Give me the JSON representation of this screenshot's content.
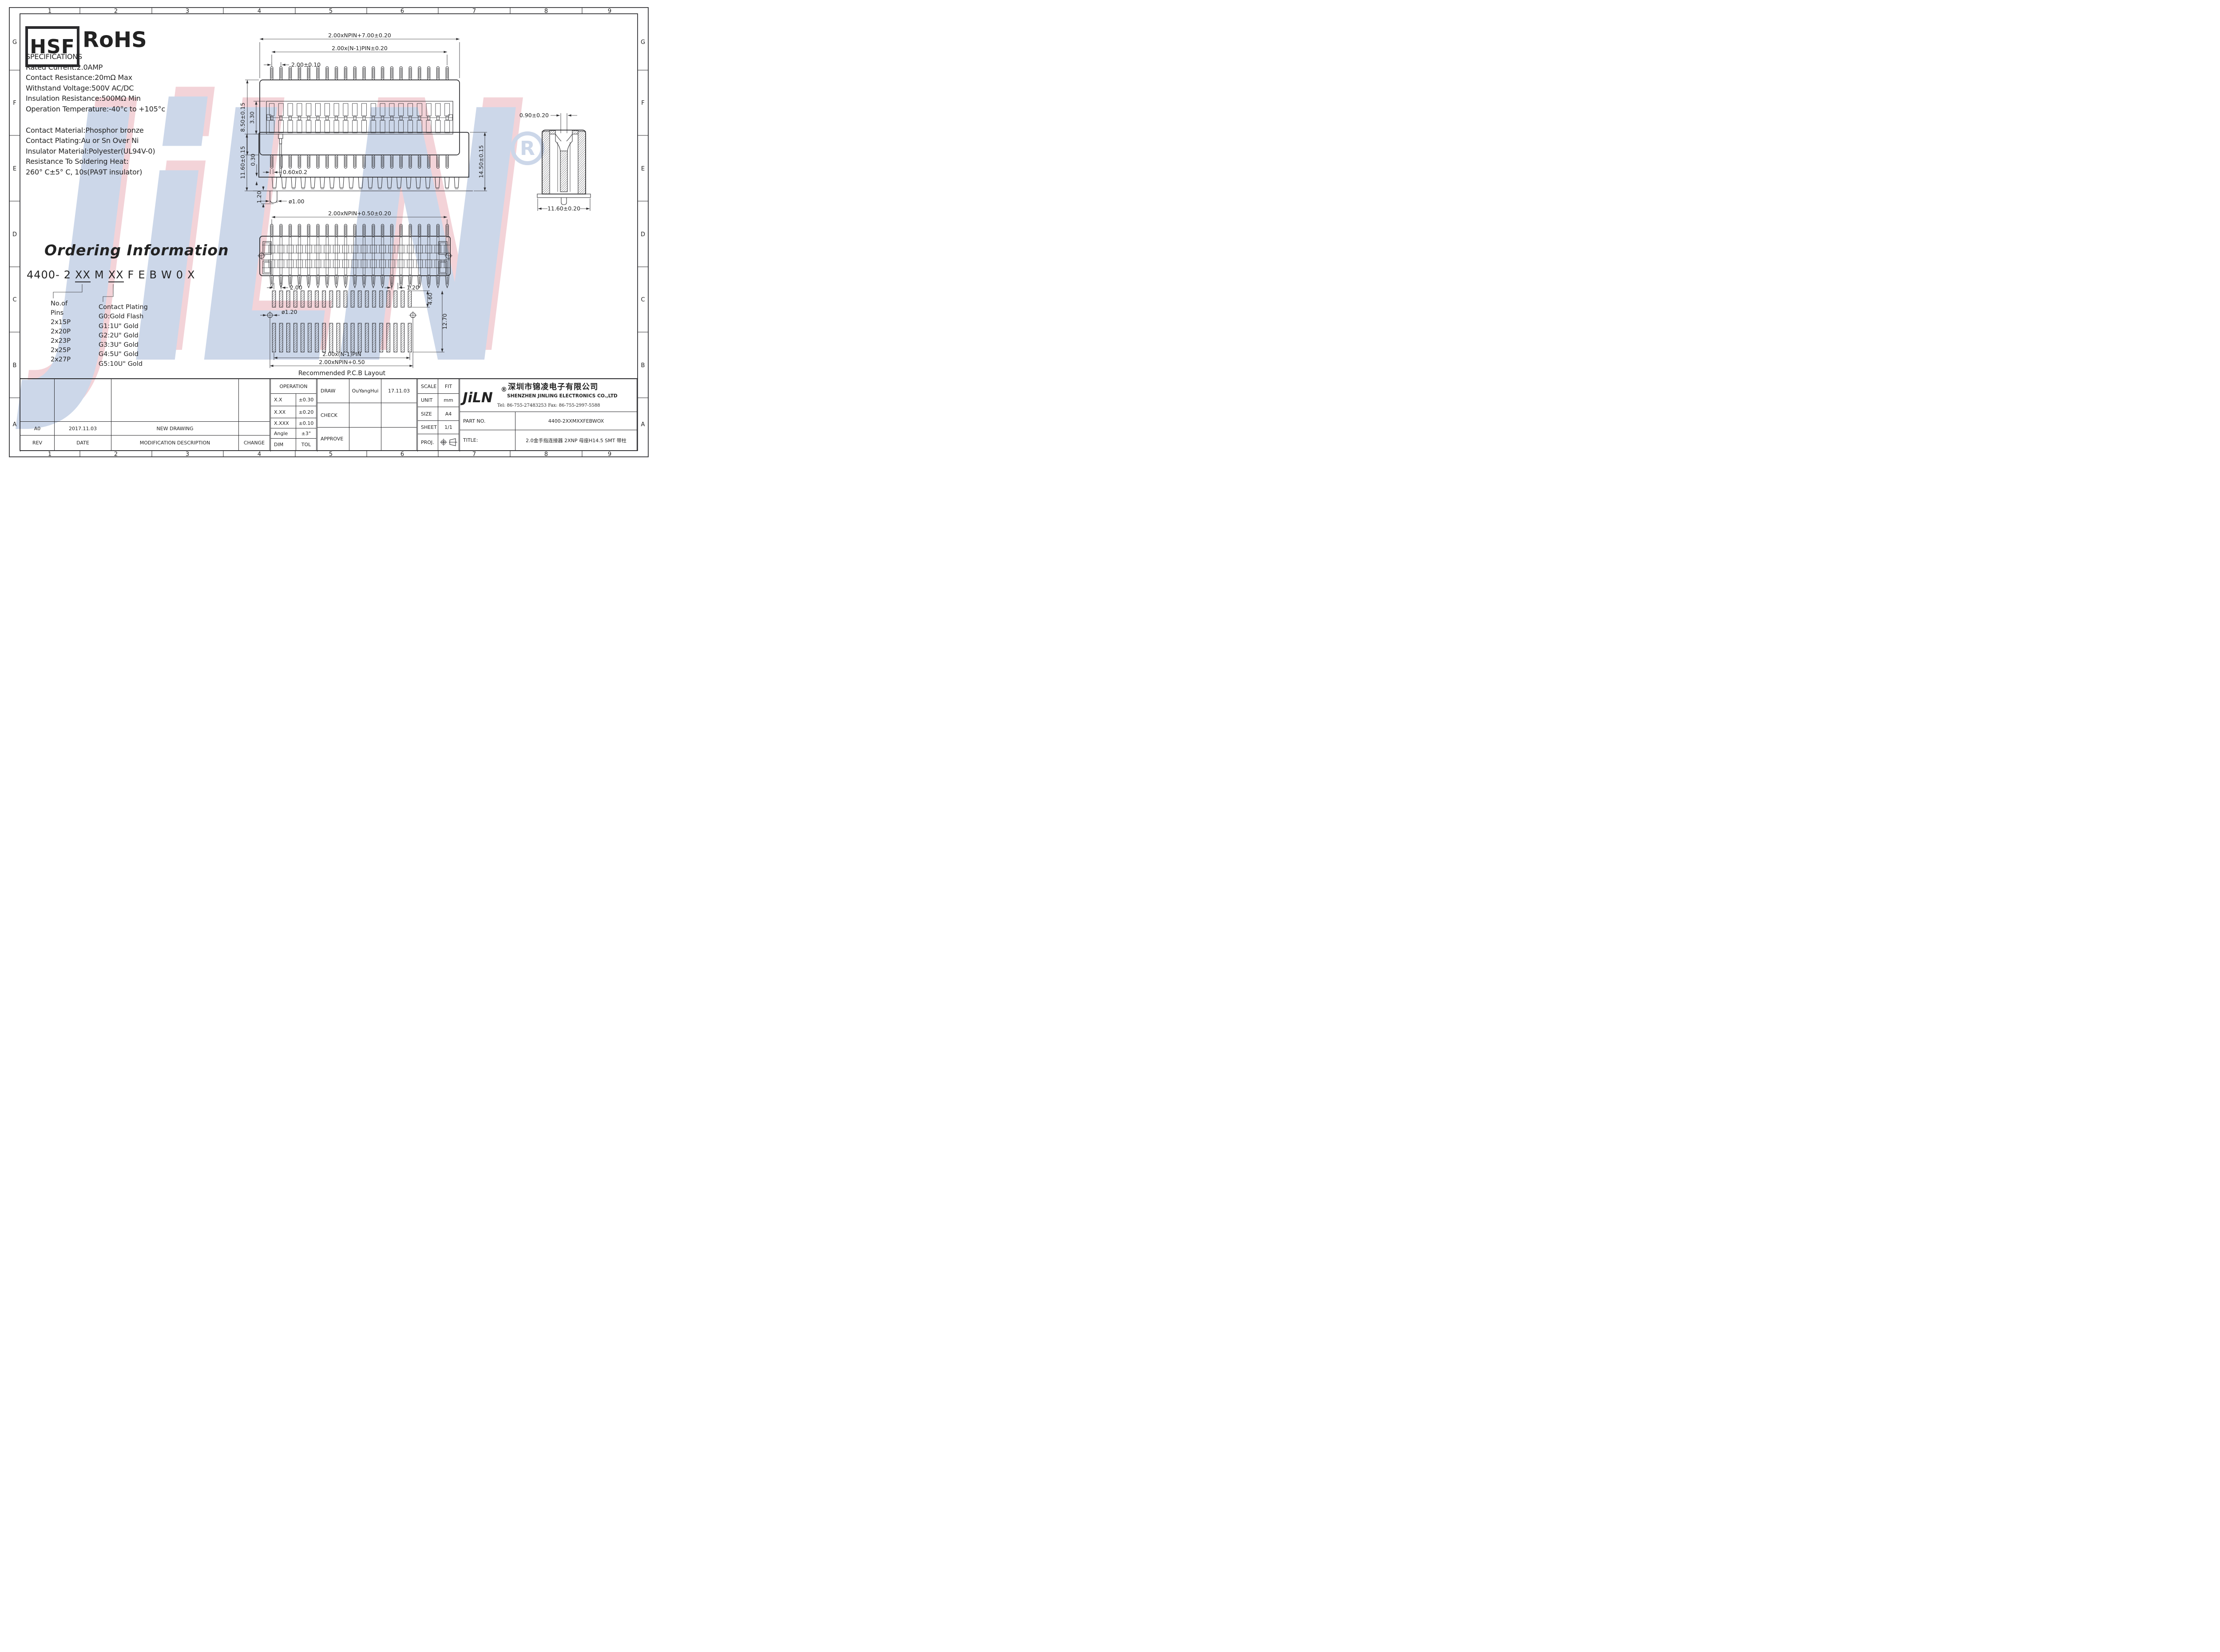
{
  "sheet": {
    "bg": "#ffffff",
    "line": "#2b2b2e"
  },
  "grid": {
    "cols": [
      "1",
      "2",
      "3",
      "4",
      "5",
      "6",
      "7",
      "8",
      "9"
    ],
    "rows": [
      "G",
      "F",
      "E",
      "D",
      "C",
      "B",
      "A"
    ]
  },
  "badges": {
    "hsf": "HSF",
    "rohs": "RoHS"
  },
  "specifications": {
    "title": "SPECIFICATIONS",
    "lines": [
      "Rated Current:2.0AMP",
      "Contact Resistance:20mΩ Max",
      "Withstand Voltage:500V AC/DC",
      "Insulation Resistance:500MΩ Min",
      "Operation Temperature:-40°c to +105°c"
    ],
    "lines2": [
      "Contact Material:Phosphor bronze",
      "Contact Plating:Au or Sn Over Ni",
      "Insulator Material:Polyester(UL94V-0)",
      "Resistance To Soldering Heat:",
      "260° C±5° C, 10s(PA9T insulator)"
    ]
  },
  "ordering": {
    "title": "Ordering Information",
    "code": {
      "c1": "4400-",
      "c2": "2",
      "c3": "XX",
      "c4": "M",
      "c5": "XX",
      "c6": "F",
      "c7": "E",
      "c8": "B",
      "c9": "W",
      "c10": "0",
      "c11": "X"
    },
    "pins": [
      "No.of",
      "Pins",
      "2x15P",
      "2x20P",
      "2x23P",
      "2x25P",
      "2x27P"
    ],
    "plating": [
      "Contact Plating",
      "G0:Gold Flash",
      "G1:1U\" Gold",
      "G2:2U\" Gold",
      "G3:3U\" Gold",
      "G4:5U\" Gold",
      "G5:10U\" Gold"
    ]
  },
  "dims": {
    "top": {
      "d1": "2.00xNPIN+7.00±0.20",
      "d2": "2.00x(N-1)PIN±0.20",
      "d3": "2.00±0.10",
      "d4": "8.50±0.15",
      "d5": "3.30",
      "d6": "0.60x0.2"
    },
    "side": {
      "d1": "11.60±0.15",
      "d2": "0.30",
      "d3": "1.20",
      "d4": "ø1.00",
      "d5": "14.50±0.15"
    },
    "front": {
      "d1": "2.00xNPIN+0.50±0.20"
    },
    "detail": {
      "d1": "0.90±0.20",
      "d2": "11.60±0.20"
    },
    "pcb": {
      "d1": "2.00",
      "d2": "1.20",
      "d3": "4.60",
      "d4": "12.70",
      "d5": "ø1.20",
      "d6": "2.00x(N-1)PIN",
      "d7": "2.00xNPIN+0.50",
      "caption": "Recommended P.C.B Layout"
    }
  },
  "revision": {
    "headers": [
      "REV",
      "DATE",
      "MODIFICATION DESCRIPTION",
      "CHANGE"
    ],
    "row": [
      "A0",
      "2017.11.03",
      "NEW DRAWING",
      ""
    ]
  },
  "tolerances": {
    "header": "OPERATION",
    "rows": [
      [
        "X.X",
        "±0.30"
      ],
      [
        "X.XX",
        "±0.20"
      ],
      [
        "X.XXX",
        "±0.10"
      ],
      [
        "Angle",
        "±3°"
      ],
      [
        "DIM",
        "TOL"
      ]
    ]
  },
  "signoff": {
    "draw": "DRAW",
    "draw_name": "OuYangHui",
    "draw_date": "17.11.03",
    "check": "CHECK",
    "approve": "APPROVE"
  },
  "info": {
    "scale_label": "SCALE",
    "scale": "FIT",
    "unit_label": "UNIT",
    "unit": "mm",
    "size_label": "SIZE",
    "size": "A4",
    "sheet_label": "SHEET",
    "sheet": "1/1",
    "proj_label": "PROJ."
  },
  "company": {
    "logo": "JiLN",
    "reg": "®",
    "name_cn": "深圳市锦凌电子有限公司",
    "name_en": "SHENZHEN JINLING ELECTRONICS CO.,LTD",
    "contact": "Tel: 86-755-27483253  Fax: 86-755-2997-5588",
    "part_label": "PART NO.",
    "part_no": "4400-2XXMXXFEBWOX",
    "title_label": "TITLE:",
    "title": "2.0金手指连接器 2XNP 母座H14.5 SMT 带柱"
  },
  "watermark": {
    "text": "JiLN",
    "reg": "R",
    "blue": "#ccd7e9",
    "pink": "#f3d3d8"
  },
  "drawing": {
    "pin_columns": 20
  }
}
